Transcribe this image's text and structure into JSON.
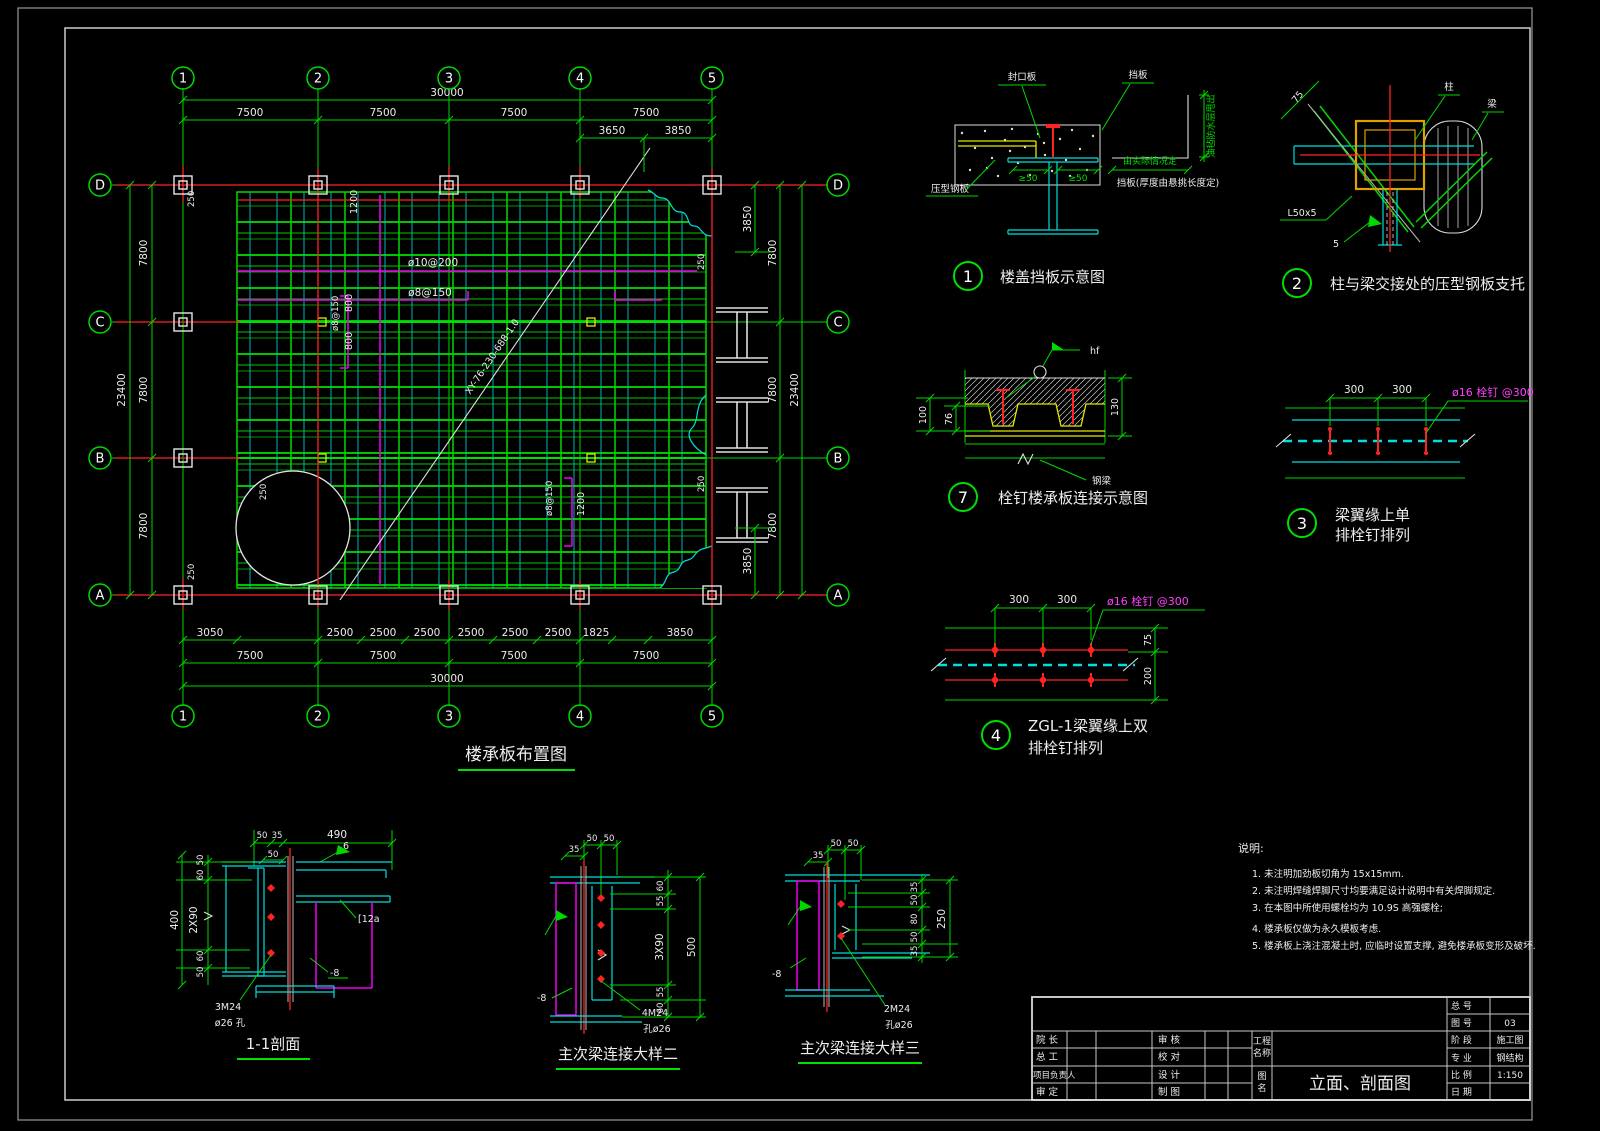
{
  "colors": {
    "background": "#000000",
    "grid_green": "#00d900",
    "deck_cyan": "#00dede",
    "axis_red": "#ff2222",
    "rebar_magenta": "#f000f0",
    "deck_yellow": "#e8e800",
    "column_orange": "#e0a000",
    "text_white": "#ededed"
  },
  "plan": {
    "title": "楼承板布置图",
    "cols": [
      "1",
      "2",
      "3",
      "4",
      "5"
    ],
    "rows": [
      "D",
      "C",
      "B",
      "A"
    ],
    "dim_overall_h": "30000",
    "dim_bay_h": "7500",
    "dim_sub_top_1": "3650",
    "dim_sub_top_2": "3850",
    "dim_overall_v": "23400",
    "dim_bay_v": "7800",
    "dim_right_sub": "3850",
    "dim_bottom": {
      "b3050": "3050",
      "b2500": "2500",
      "b1825": "1825",
      "b3850": "3850"
    },
    "off250": "250",
    "ann": {
      "v1200": "1200",
      "r10": "ø10@200",
      "r8": "ø8@150",
      "v800": "800",
      "deck_type": "XY-76-230-688-1.0"
    }
  },
  "d1": {
    "no": "1",
    "title": "楼盖挡板示意图",
    "seal_plate": "封口板",
    "baffle": "挡板",
    "deck_plate": "压型钢板",
    "ge50": "≥50",
    "by_site": "由实际情况定",
    "baffle_note": "挡板(厚度由悬挑长度定)",
    "edge_note": "油毡防水层甩出"
  },
  "d2": {
    "no": "2",
    "title": "柱与梁交接处的压型钢板支托",
    "d75": "75",
    "column": "柱",
    "beam": "梁",
    "angle": "L50x5",
    "weld": "5"
  },
  "d7": {
    "no": "7",
    "title": "栓钉楼承板连接示意图",
    "d100": "100",
    "d76": "76",
    "d130": "130",
    "weld_hf": "hf",
    "beam": "钢梁"
  },
  "d3": {
    "no": "3",
    "title1": "梁翼缘上单",
    "title2": "排栓钉排列",
    "d300": "300",
    "stud": "ø16 栓钉 @300"
  },
  "d4": {
    "no": "4",
    "title1": "ZGL-1梁翼缘上双",
    "title2": "排栓钉排列",
    "d300": "300",
    "d75": "75",
    "d200": "200",
    "stud": "ø16 栓钉 @300"
  },
  "s11": {
    "title": "1-1剖面",
    "d50": "50",
    "d35": "35",
    "d490": "490",
    "d60": "60",
    "d2x90": "2X90",
    "d400": "400",
    "weld6": "6",
    "channel": "[12a",
    "plate": "-8",
    "bolts": "3M24",
    "hole": "ø26 孔"
  },
  "s2": {
    "title": "主次梁连接大样二",
    "d35": "35",
    "d50": "50",
    "d60": "60",
    "d55": "55",
    "d3x90": "3X90",
    "d500": "500",
    "plate": "-8",
    "bolts": "4M24",
    "hole": "孔ø26"
  },
  "s3": {
    "title": "主次梁连接大样三",
    "d35": "35",
    "d50": "50",
    "d80": "80",
    "d250": "250",
    "plate": "-8",
    "bolts": "2M24",
    "hole": "孔ø26"
  },
  "notes": {
    "header": "说明:",
    "n1": "1. 未注明加劲板切角为  15x15mm.",
    "n2": "2. 未注明焊缝焊脚尺寸均要满足设计说明中有关焊脚规定.",
    "n3": "3. 在本图中所使用螺栓均为 10.9S 高强螺栓;",
    "n4": "4. 楼承板仅做为永久模板考虑.",
    "n5": "5. 楼承板上浇注混凝土时, 应临时设置支撑, 避免楼承板变形及破坏."
  },
  "tb": {
    "director": "院 长",
    "chief": "总 工",
    "project_lead": "项目负责人",
    "approver": "审 定",
    "reviewer": "审 核",
    "proofreader": "校 对",
    "designer": "设 计",
    "drafter": "制 图",
    "project_label_1": "工程",
    "project_label_2": "名称",
    "name_label_1": "图",
    "name_label_2": "名",
    "drawing_title": "立面、剖面图",
    "info": {
      "l1": "总 号",
      "l2": "图 号",
      "l3": "阶 段",
      "l4": "专 业",
      "l5": "比 例",
      "l6": "日 期",
      "v2": "03",
      "v3": "施工图",
      "v4": "钢结构",
      "v5": "1:150"
    }
  }
}
